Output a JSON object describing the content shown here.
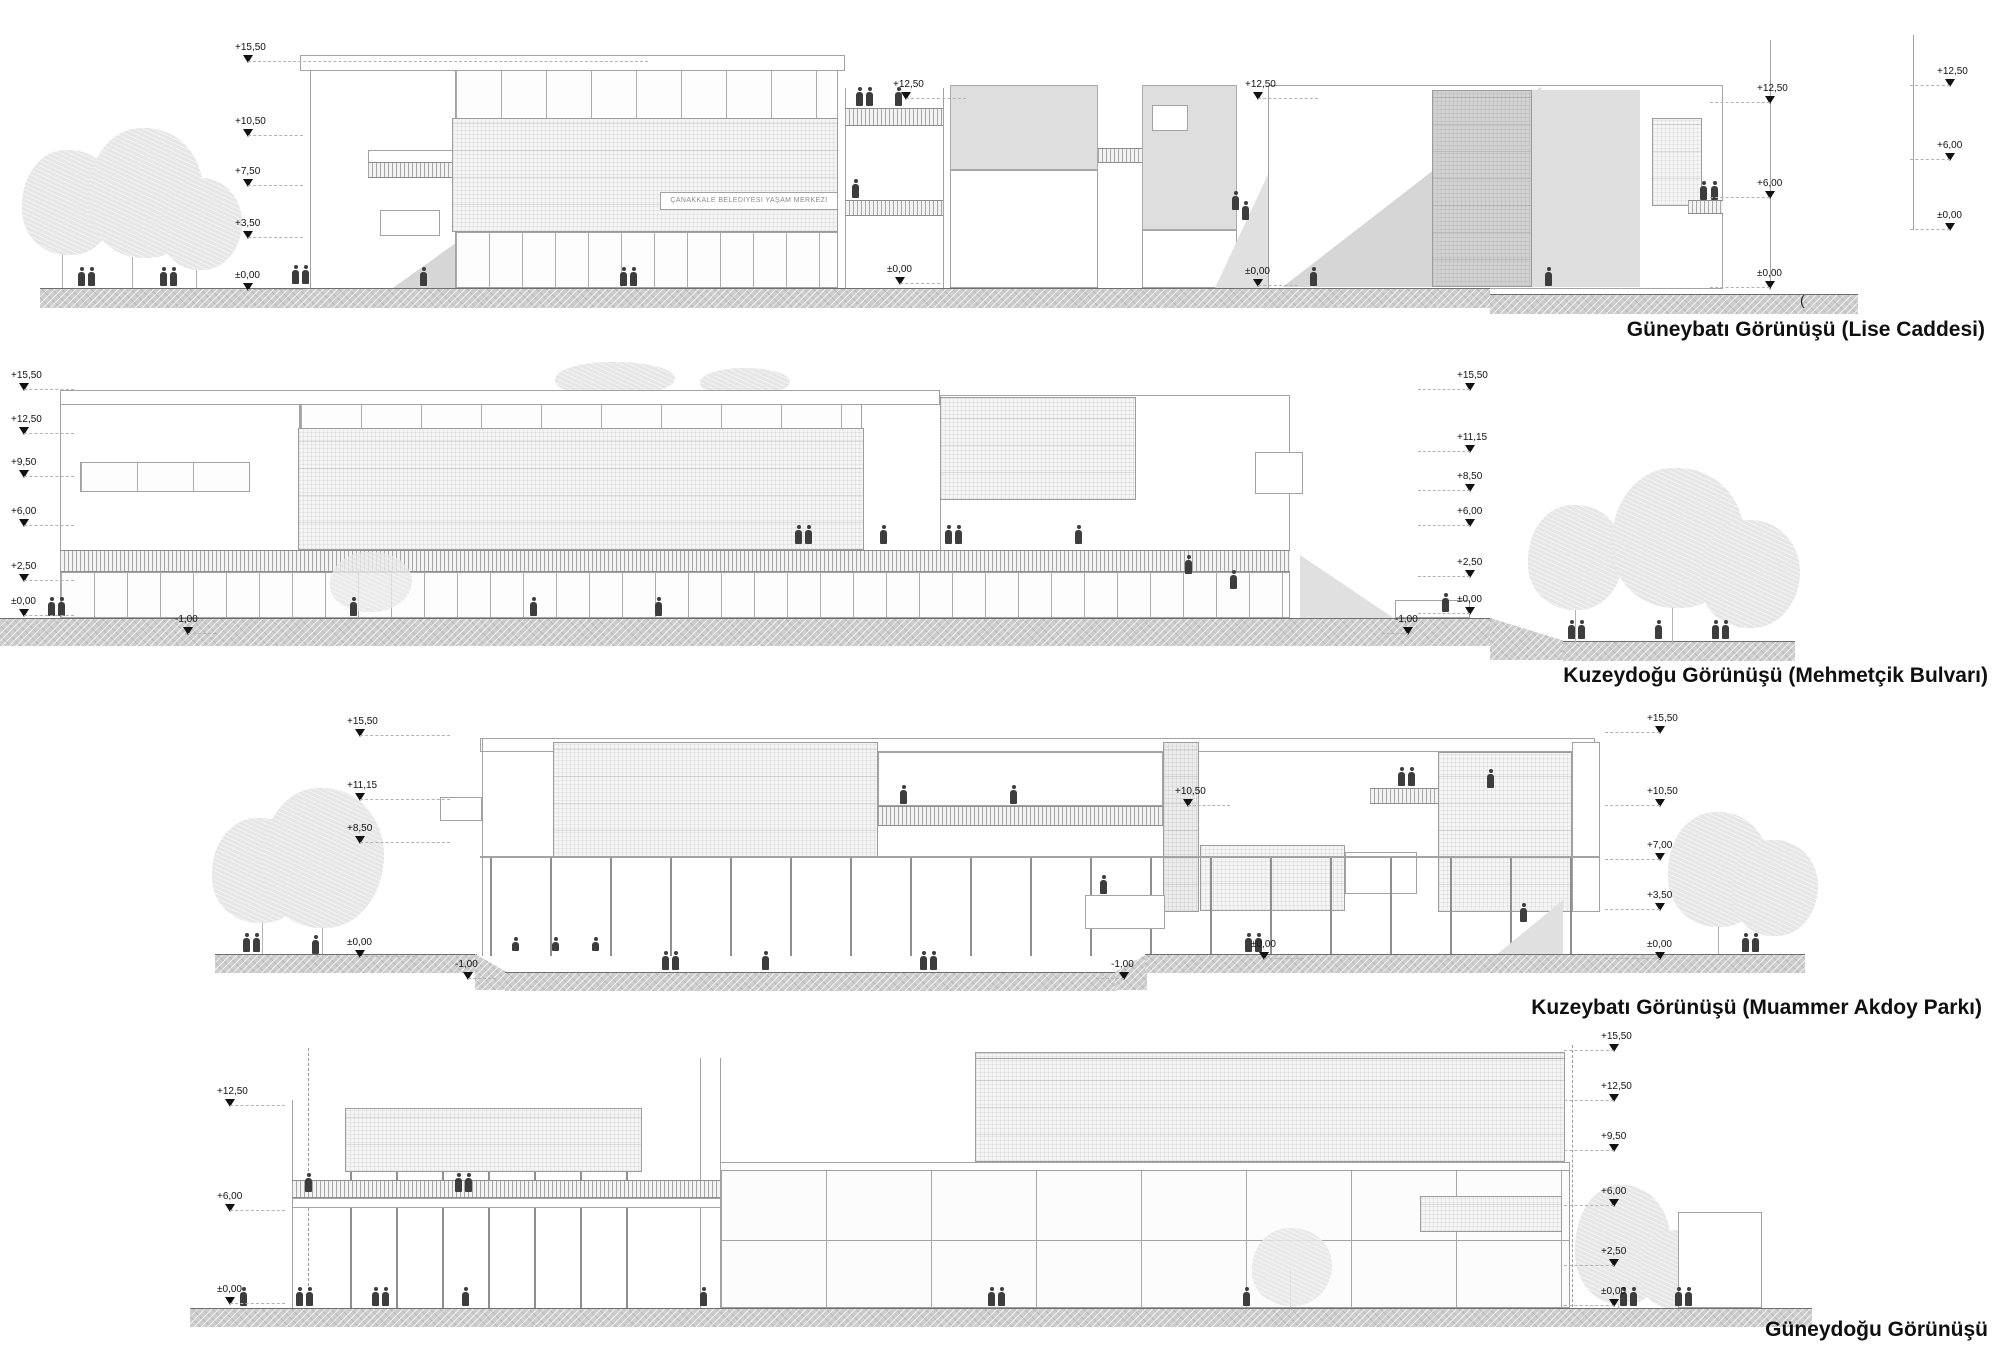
{
  "building_sign": "ÇANAKKALE BELEDİYESİ YAŞAM MERKEZİ",
  "stray_open_paren": "(",
  "colors": {
    "paper": "#ffffff",
    "line": "#a3a3a3",
    "marker": "#121212",
    "caption": "#101010",
    "ground": "#cdcdcd",
    "shadow": "#d6d6d6",
    "tree": "#e6e6e6",
    "person": "#3d3d3d"
  },
  "elevations": [
    {
      "id": "southwest",
      "caption": "Güneybatı Görünüşü (Lise Caddesi)",
      "markers": [
        {
          "v": "+15,50",
          "x": 248,
          "y": 62,
          "lead": 400
        },
        {
          "v": "+10,50",
          "x": 248,
          "y": 136,
          "lead": 55
        },
        {
          "v": "+7,50",
          "x": 248,
          "y": 186,
          "lead": 55
        },
        {
          "v": "+3,50",
          "x": 248,
          "y": 238,
          "lead": 55
        },
        {
          "v": "±0,00",
          "x": 248,
          "y": 290,
          "lead": 55
        },
        {
          "v": "+12,50",
          "x": 906,
          "y": 99,
          "lead": 60
        },
        {
          "v": "±0,00",
          "x": 900,
          "y": 284,
          "lead": 40
        },
        {
          "v": "+12,50",
          "x": 1258,
          "y": 99,
          "lead": 60
        },
        {
          "v": "±0,00",
          "x": 1258,
          "y": 286,
          "lead": 40
        },
        {
          "v": "+12,50",
          "x": 1770,
          "y": 103,
          "lead": -60
        },
        {
          "v": "+6,00",
          "x": 1770,
          "y": 198,
          "lead": -60
        },
        {
          "v": "±0,00",
          "x": 1770,
          "y": 288,
          "lead": -60
        },
        {
          "v": "+12,50",
          "x": 1950,
          "y": 86,
          "lead": -40
        },
        {
          "v": "+6,00",
          "x": 1950,
          "y": 160,
          "lead": -40
        },
        {
          "v": "±0,00",
          "x": 1950,
          "y": 230,
          "lead": -40
        }
      ]
    },
    {
      "id": "northeast",
      "caption": "Kuzeydoğu Görünüşü (Mehmetçik Bulvarı)",
      "markers": [
        {
          "v": "+15,50",
          "x": 24,
          "y": 390,
          "lead": 50
        },
        {
          "v": "+12,50",
          "x": 24,
          "y": 434,
          "lead": 50
        },
        {
          "v": "+9,50",
          "x": 24,
          "y": 477,
          "lead": 50
        },
        {
          "v": "+6,00",
          "x": 24,
          "y": 526,
          "lead": 50
        },
        {
          "v": "+2,50",
          "x": 24,
          "y": 581,
          "lead": 50
        },
        {
          "v": "±0,00",
          "x": 24,
          "y": 616,
          "lead": 50
        },
        {
          "v": "-1,00",
          "x": 188,
          "y": 634,
          "lead": 28
        },
        {
          "v": "+15,50",
          "x": 1470,
          "y": 390,
          "lead": -52
        },
        {
          "v": "+11,15",
          "x": 1470,
          "y": 452,
          "lead": -52
        },
        {
          "v": "+8,50",
          "x": 1470,
          "y": 491,
          "lead": -52
        },
        {
          "v": "+6,00",
          "x": 1470,
          "y": 526,
          "lead": -52
        },
        {
          "v": "+2,50",
          "x": 1470,
          "y": 577,
          "lead": -52
        },
        {
          "v": "±0,00",
          "x": 1470,
          "y": 614,
          "lead": -52
        },
        {
          "v": "-1,00",
          "x": 1408,
          "y": 634,
          "lead": -26
        }
      ]
    },
    {
      "id": "northwest",
      "caption": "Kuzeybatı Görünüşü (Muammer Akdoy Parkı)",
      "markers": [
        {
          "v": "+15,50",
          "x": 360,
          "y": 736,
          "lead": 90
        },
        {
          "v": "+11,15",
          "x": 360,
          "y": 800,
          "lead": 90
        },
        {
          "v": "+8,50",
          "x": 360,
          "y": 843,
          "lead": 90
        },
        {
          "v": "±0,00",
          "x": 360,
          "y": 957,
          "lead": 55
        },
        {
          "v": "-1,00",
          "x": 468,
          "y": 979,
          "lead": 28
        },
        {
          "v": "+10,50",
          "x": 1188,
          "y": 806,
          "lead": 42
        },
        {
          "v": "±0,00",
          "x": 1264,
          "y": 959,
          "lead": 40
        },
        {
          "v": "-1,00",
          "x": 1124,
          "y": 979,
          "lead": -28
        },
        {
          "v": "+15,50",
          "x": 1660,
          "y": 733,
          "lead": -55
        },
        {
          "v": "+10,50",
          "x": 1660,
          "y": 806,
          "lead": -55
        },
        {
          "v": "+7,00",
          "x": 1660,
          "y": 860,
          "lead": -55
        },
        {
          "v": "+3,50",
          "x": 1660,
          "y": 910,
          "lead": -55
        },
        {
          "v": "±0,00",
          "x": 1660,
          "y": 959,
          "lead": -55
        }
      ]
    },
    {
      "id": "southeast",
      "caption": "Güneydoğu Görünüşü",
      "markers": [
        {
          "v": "+12,50",
          "x": 230,
          "y": 1106,
          "lead": 55
        },
        {
          "v": "+6,00",
          "x": 230,
          "y": 1211,
          "lead": 55
        },
        {
          "v": "±0,00",
          "x": 230,
          "y": 1304,
          "lead": 55
        },
        {
          "v": "+15,50",
          "x": 1614,
          "y": 1051,
          "lead": -50
        },
        {
          "v": "+12,50",
          "x": 1614,
          "y": 1101,
          "lead": -50
        },
        {
          "v": "+9,50",
          "x": 1614,
          "y": 1151,
          "lead": -50
        },
        {
          "v": "+6,00",
          "x": 1614,
          "y": 1206,
          "lead": -50
        },
        {
          "v": "+2,50",
          "x": 1614,
          "y": 1266,
          "lead": -50
        },
        {
          "v": "±0,00",
          "x": 1614,
          "y": 1306,
          "lead": -50
        }
      ]
    }
  ]
}
